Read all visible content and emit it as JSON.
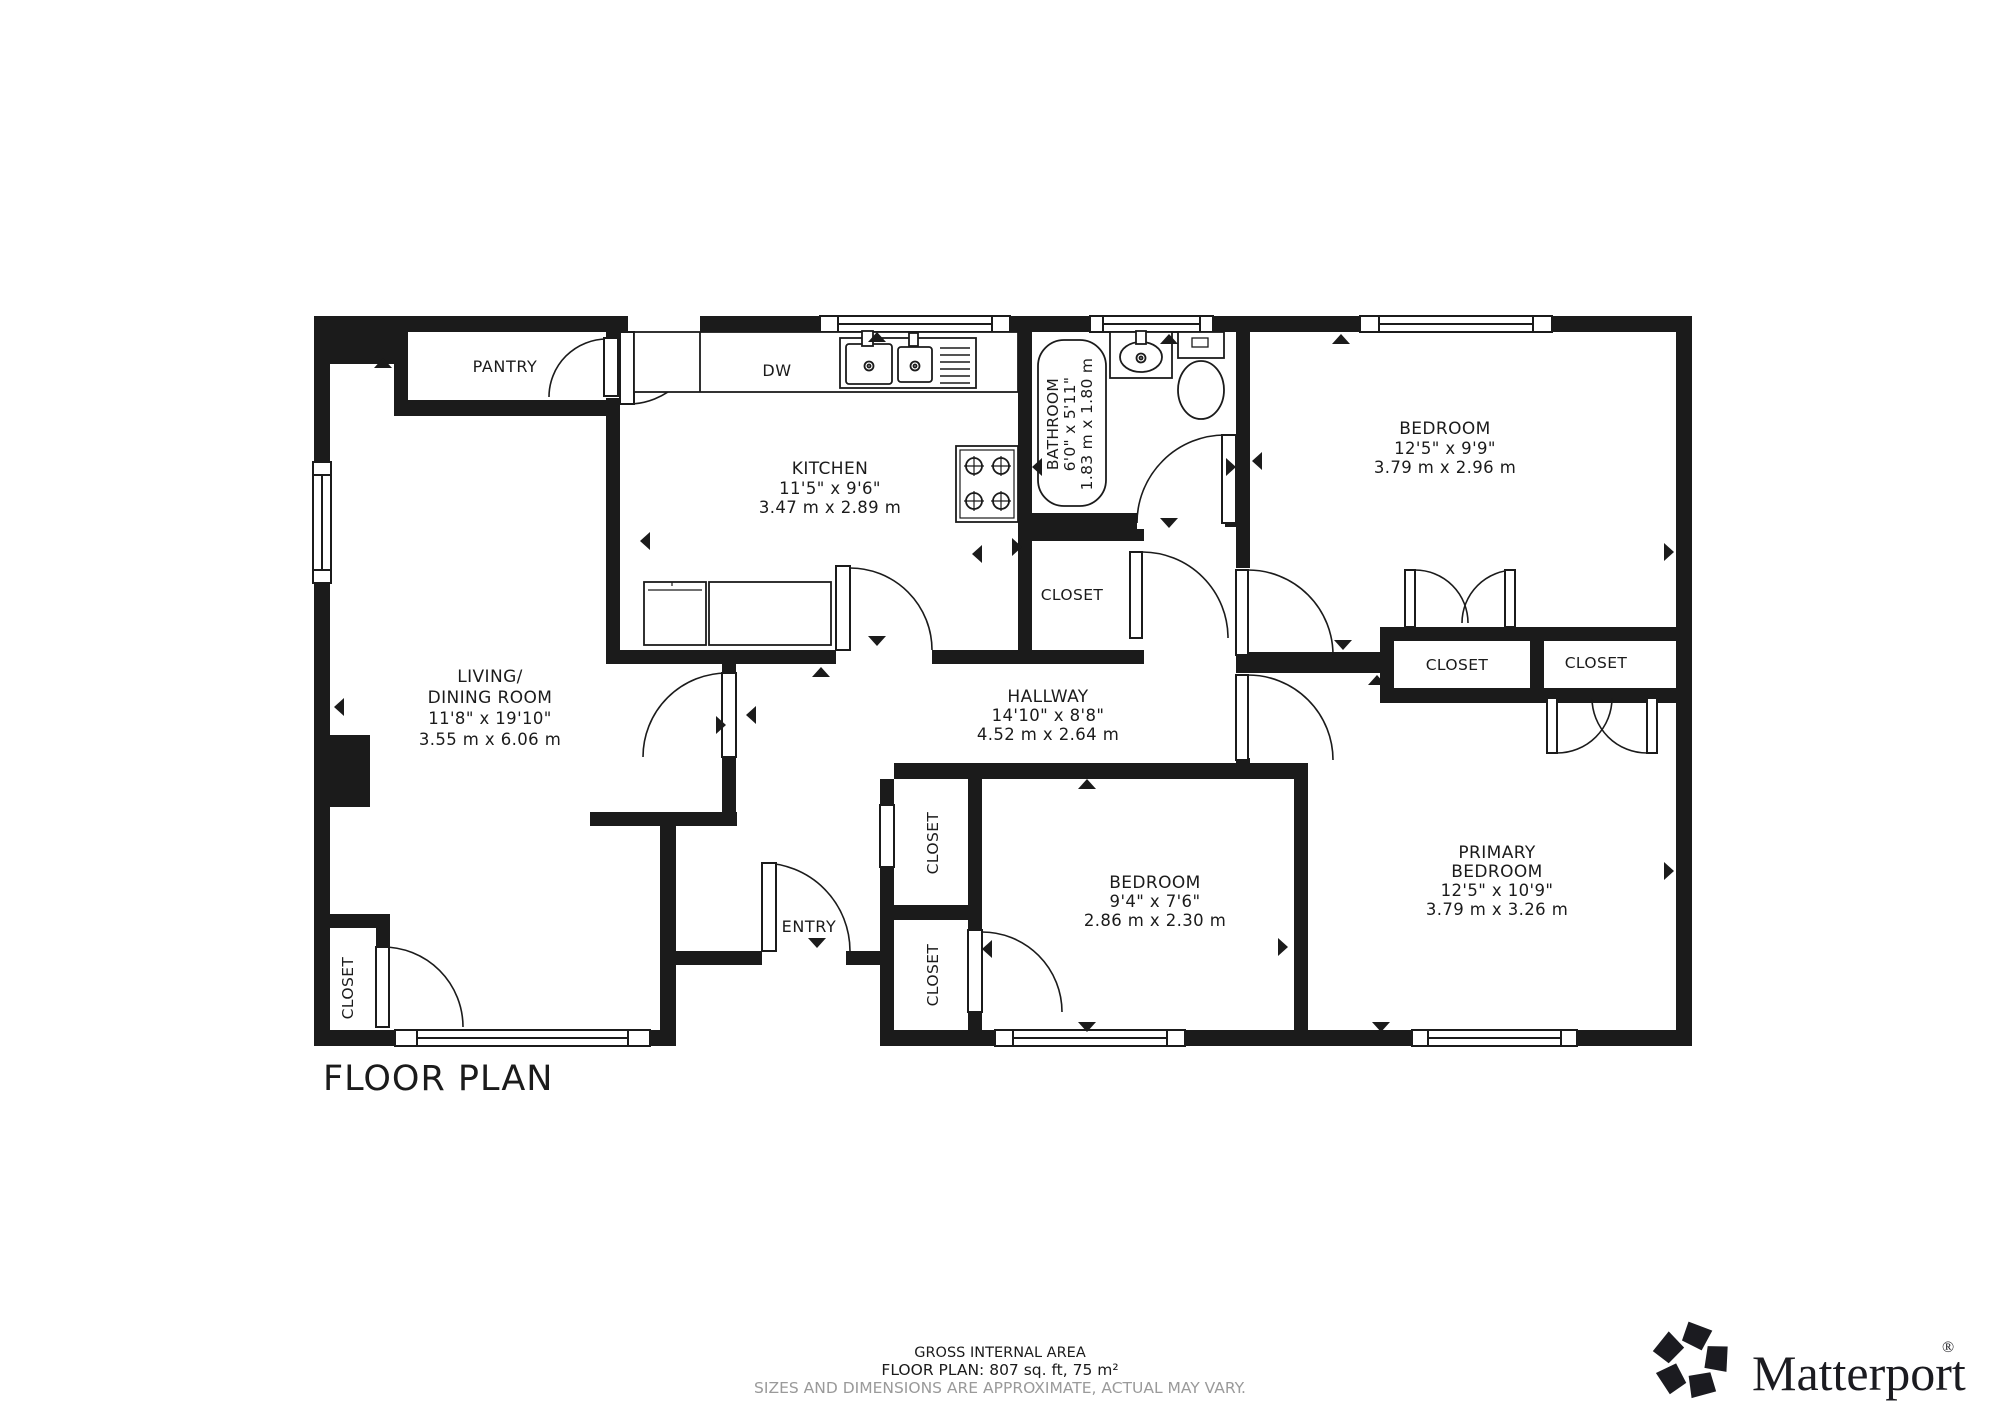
{
  "colors": {
    "ink": "#1b1b1b",
    "muted": "#9a9a9a"
  },
  "plan": {
    "title": "FLOOR PLAN",
    "labels": {
      "pantry": "PANTRY",
      "dishwasher": "DW",
      "entry": "ENTRY",
      "closet": "CLOSET"
    },
    "rooms": {
      "living": {
        "name_line1": "LIVING/",
        "name_line2": "DINING ROOM",
        "size_imperial": "11'8\" x 19'10\"",
        "size_metric": "3.55 m x 6.06 m"
      },
      "kitchen": {
        "name": "KITCHEN",
        "size_imperial": "11'5\" x 9'6\"",
        "size_metric": "3.47 m x 2.89 m"
      },
      "bathroom": {
        "name": "BATHROOM",
        "size_imperial": "6'0\" x 5'11\"",
        "size_metric": "1.83 m x 1.80 m"
      },
      "hallway": {
        "name": "HALLWAY",
        "size_imperial": "14'10\" x 8'8\"",
        "size_metric": "4.52 m x 2.64 m"
      },
      "bedroom_top": {
        "name": "BEDROOM",
        "size_imperial": "12'5\" x 9'9\"",
        "size_metric": "3.79 m x 2.96 m"
      },
      "bedroom_middle": {
        "name": "BEDROOM",
        "size_imperial": "9'4\" x 7'6\"",
        "size_metric": "2.86 m x 2.30 m"
      },
      "primary_bedroom": {
        "name_line1": "PRIMARY",
        "name_line2": "BEDROOM",
        "size_imperial": "12'5\" x 10'9\"",
        "size_metric": "3.79 m x 3.26 m"
      }
    }
  },
  "footer": {
    "line1": "GROSS INTERNAL AREA",
    "line2": "FLOOR PLAN: 807 sq. ft, 75 m²",
    "line3": "SIZES AND DIMENSIONS ARE APPROXIMATE, ACTUAL MAY VARY."
  },
  "brand": {
    "name": "Matterport",
    "registered": "®"
  }
}
